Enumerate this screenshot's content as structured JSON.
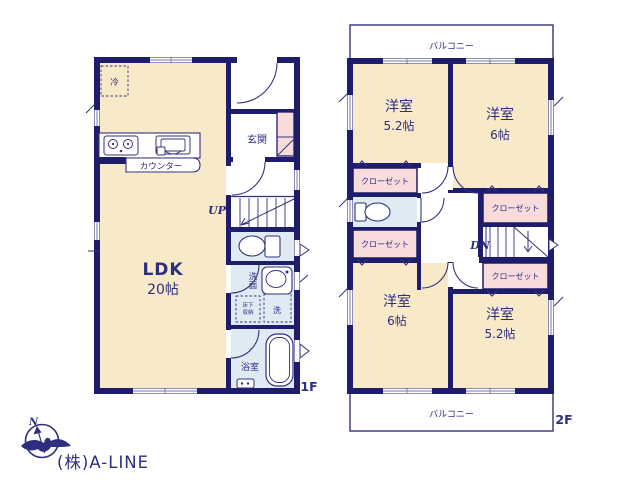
{
  "branding": {
    "company": "(株)A-LINE",
    "compass_north": "N"
  },
  "colors": {
    "wall": "#1d1d6b",
    "line": "#32327e",
    "floor_cream": "#f8e9c9",
    "closet_pink": "#f8dcdc",
    "wet_area_blue": "#dfeaf3",
    "window_line": "#8f8fc0",
    "label_text": "#2e2e7e",
    "logo_text_gray": "#e2e2e2"
  },
  "floor1": {
    "label": "1F",
    "ldk_name": "LDK",
    "ldk_size": "20帖",
    "genkan": "玄関",
    "counter": "カウンター",
    "fridge": "冷",
    "stairs_up": "UP",
    "washroom": "洗面",
    "underfloor_line1": "床下",
    "underfloor_line2": "収納",
    "laundry": "洗",
    "bath": "浴室"
  },
  "floor2": {
    "label": "2F",
    "balcony_top": "バルコニー",
    "balcony_bottom": "バルコニー",
    "stairs_down": "DN",
    "rooms": [
      {
        "id": "nw",
        "name": "洋室",
        "size": "5.2帖"
      },
      {
        "id": "ne",
        "name": "洋室",
        "size": "6帖"
      },
      {
        "id": "sw",
        "name": "洋室",
        "size": "6帖"
      },
      {
        "id": "se",
        "name": "洋室",
        "size": "5.2帖"
      }
    ],
    "closets": [
      {
        "label": "クローゼット"
      },
      {
        "label": "クローゼット"
      },
      {
        "label": "クローゼット"
      },
      {
        "label": "クローゼット"
      }
    ]
  }
}
